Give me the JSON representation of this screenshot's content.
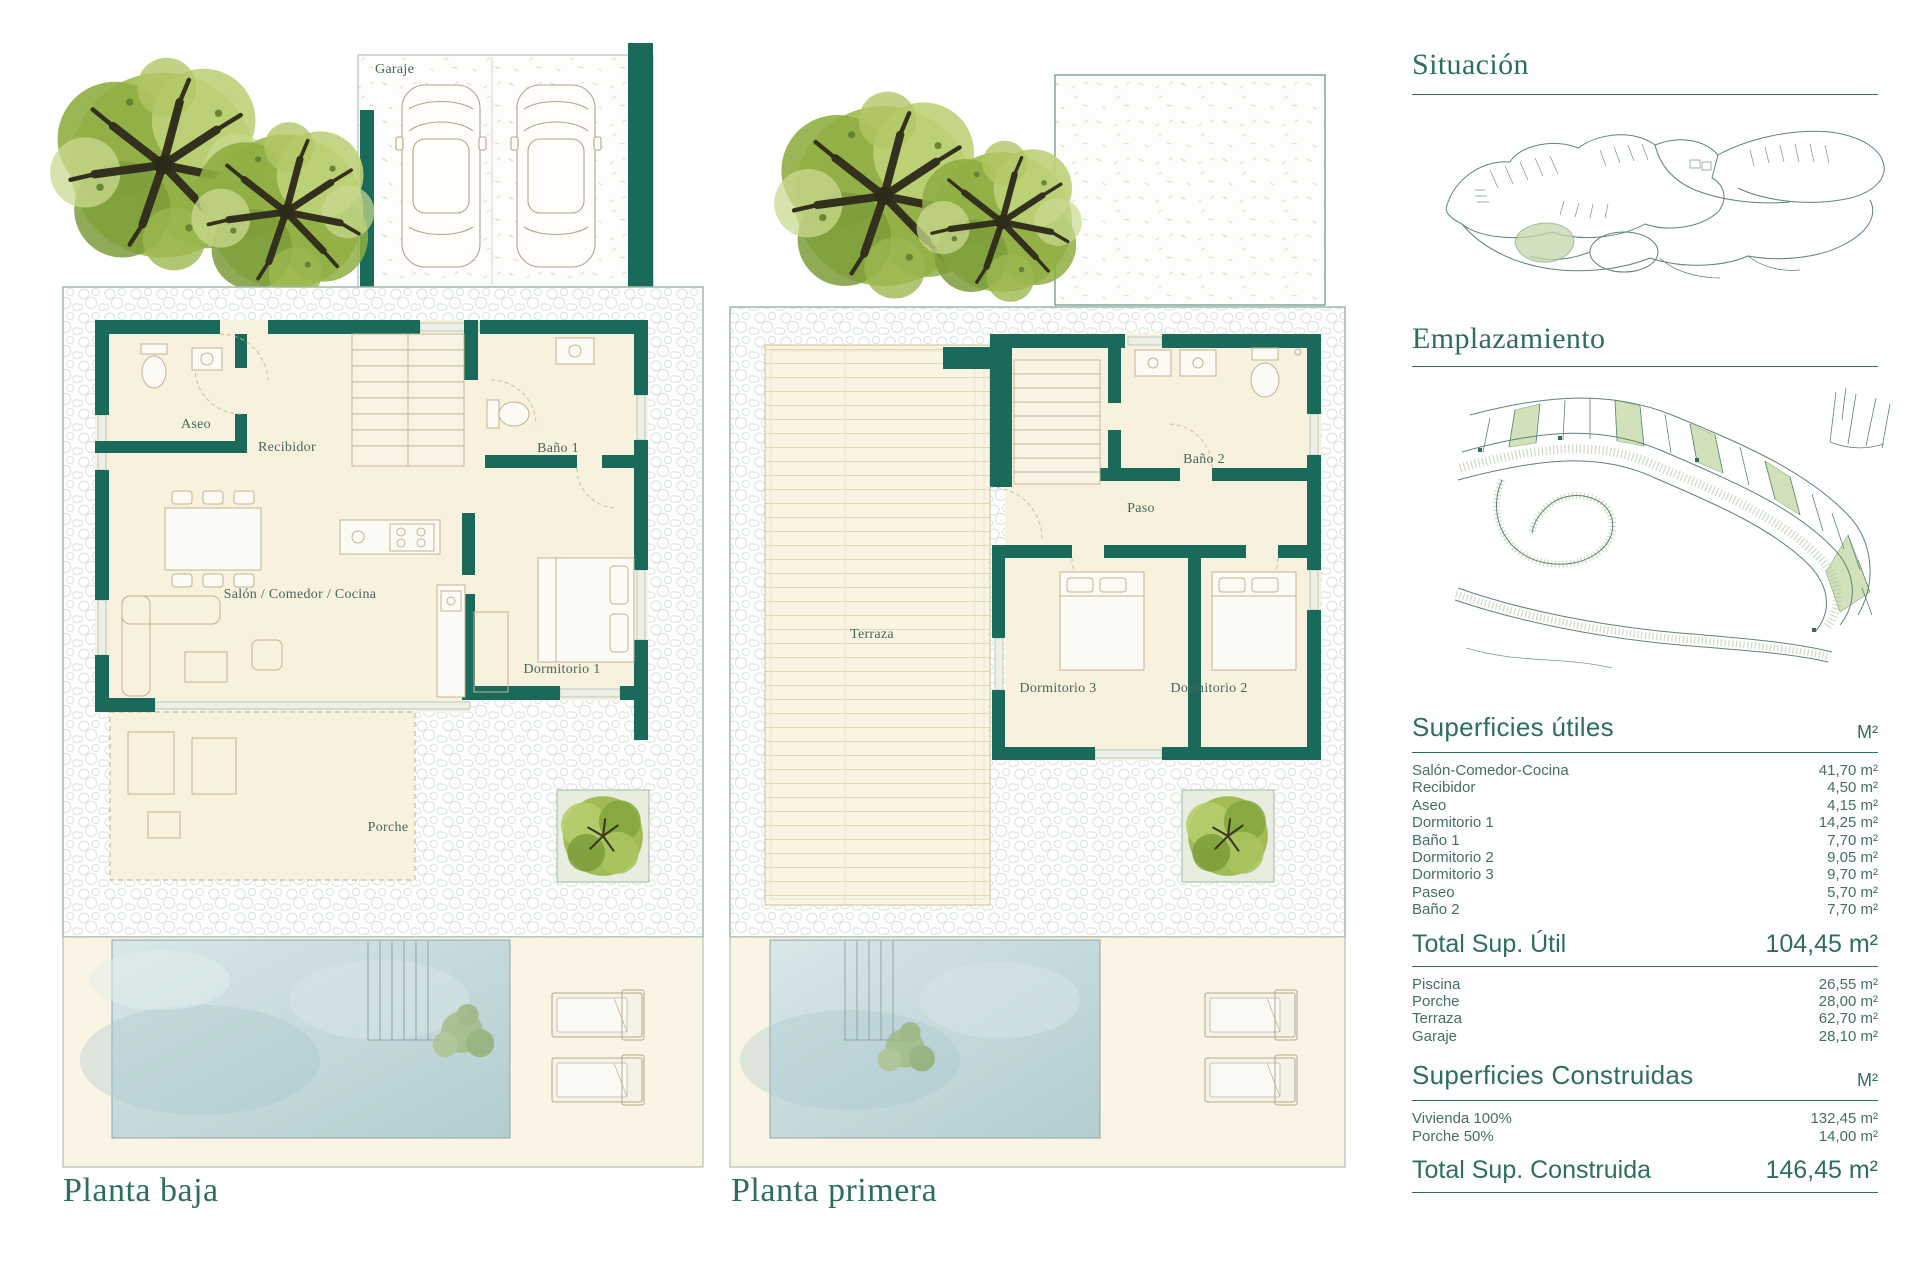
{
  "colors": {
    "accent": "#2d6e5f",
    "wall": "#196a5b",
    "room_fill": "#f7f1dd",
    "pool": "#c3d8db",
    "plot_border": "#a2b7aa"
  },
  "ground_floor": {
    "title": "Planta baja",
    "labels": {
      "garaje": "Garaje",
      "aseo": "Aseo",
      "recibidor": "Recibidor",
      "bano1": "Baño 1",
      "salon": "Salón / Comedor / Cocina",
      "dormitorio1": "Dormitorio 1",
      "porche": "Porche"
    }
  },
  "first_floor": {
    "title": "Planta primera",
    "labels": {
      "terraza": "Terraza",
      "bano2": "Baño 2",
      "paso": "Paso",
      "dormitorio3": "Dormitorio 3",
      "dormitorio2": "Dormitorio 2"
    }
  },
  "sidebar": {
    "situacion": {
      "title": "Situación"
    },
    "emplazamiento": {
      "title": "Emplazamiento"
    },
    "superficies_utiles": {
      "title": "Superficies útiles",
      "unit": "M²",
      "rows": [
        {
          "label": "Salón-Comedor-Cocina",
          "value": "41,70 m²"
        },
        {
          "label": "Recibidor",
          "value": "4,50 m²"
        },
        {
          "label": "Aseo",
          "value": "4,15 m²"
        },
        {
          "label": "Dormitorio 1",
          "value": "14,25 m²"
        },
        {
          "label": "Baño 1",
          "value": "7,70 m²"
        },
        {
          "label": "Dormitorio 2",
          "value": "9,05 m²"
        },
        {
          "label": "Dormitorio 3",
          "value": "9,70 m²"
        },
        {
          "label": "Paseo",
          "value": "5,70 m²"
        },
        {
          "label": "Baño 2",
          "value": "7,70 m²"
        }
      ],
      "total": {
        "label": "Total Sup. Útil",
        "value": "104,45 m²"
      }
    },
    "exterior": {
      "rows": [
        {
          "label": "Piscina",
          "value": "26,55 m²"
        },
        {
          "label": "Porche",
          "value": "28,00 m²"
        },
        {
          "label": "Terraza",
          "value": "62,70 m²"
        },
        {
          "label": "Garaje",
          "value": "28,10 m²"
        }
      ]
    },
    "superficies_construidas": {
      "title": "Superficies Construidas",
      "unit": "M²",
      "rows": [
        {
          "label": "Vivienda 100%",
          "value": "132,45 m²"
        },
        {
          "label": "Porche 50%",
          "value": "14,00 m²"
        }
      ],
      "total": {
        "label": "Total Sup. Construida",
        "value": "146,45 m²"
      }
    }
  }
}
